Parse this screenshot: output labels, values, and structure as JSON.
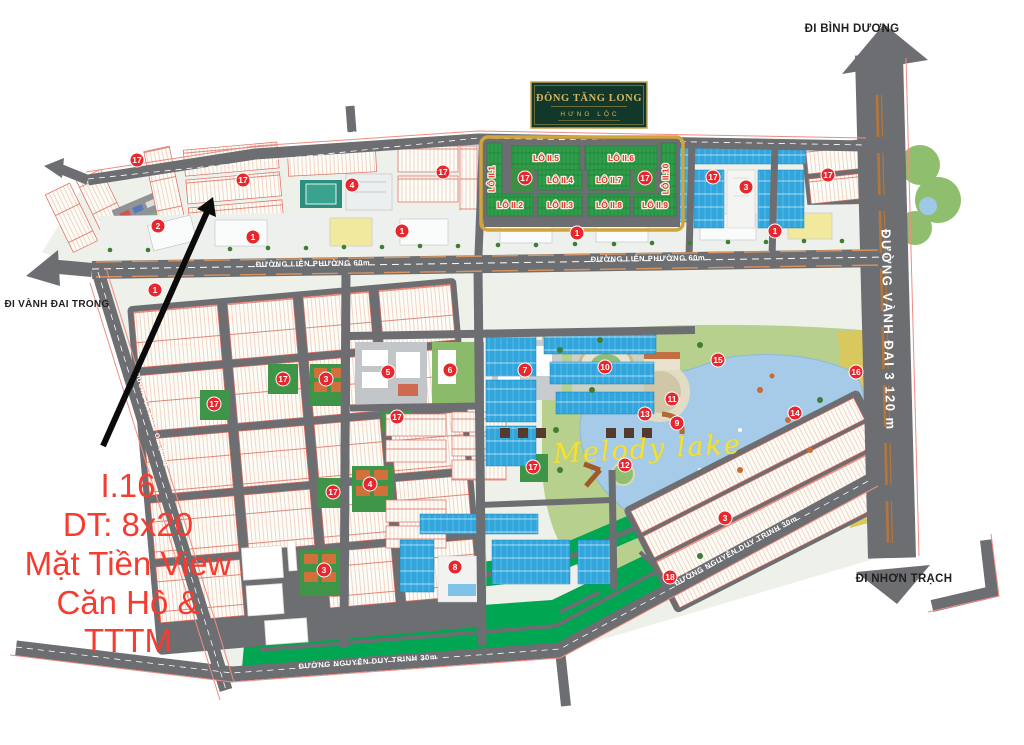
{
  "app": {
    "title": "Sơ đồ phân lô Đông Tăng Long - Hưng Lộc"
  },
  "logo": {
    "name": "ĐÔNG TĂNG LONG",
    "sub": "HƯNG LỘC"
  },
  "directions": {
    "north": "ĐI BÌNH DƯƠNG",
    "south": "ĐI NHƠN TRẠCH",
    "west": "ĐI VÀNH ĐAI TRONG"
  },
  "roads": {
    "vanh_dai_3": "ĐƯỜNG VÀNH ĐAI 3  120 m",
    "lien_phuong": "ĐƯỜNG LIÊN PHƯỜNG  60m",
    "nguyen_duy_trinh": "ĐƯỜNG NGUYỄN DUY TRINH  30m",
    "a1": "ĐƯỜNG A1  20m",
    "la_xuan_oai": "ĐƯỜNG LÃ XUÂN OAI (60m)"
  },
  "lake": {
    "name": "Melody lake"
  },
  "highlight_lots": [
    "LÔ II.1",
    "LÔ II.2",
    "LÔ II.3",
    "LÔ II.4",
    "LÔ II.5",
    "LÔ II.6",
    "LÔ II.7",
    "LÔ II.8",
    "LÔ II.9",
    "LÔ II.10"
  ],
  "annotation": {
    "lines": [
      "I.16",
      "DT: 8x20",
      "Mặt Tiền View",
      "Căn Hộ &",
      "TTTM"
    ]
  },
  "markers": [
    "17",
    "2",
    "17",
    "1",
    "4",
    "17",
    "1",
    "17",
    "17",
    "1",
    "3",
    "17",
    "17",
    "1",
    "1",
    "5",
    "6",
    "7",
    "10",
    "15",
    "16",
    "14",
    "11",
    "13",
    "9",
    "12",
    "17",
    "3",
    "17",
    "17",
    "17",
    "4",
    "17",
    "8",
    "3",
    "18",
    "3"
  ],
  "colors": {
    "marker": "#e8262d",
    "highlight_border": "#d2a43c",
    "lot_green": "#2f9e4a",
    "cyan_lot": "#31a5dc",
    "strip_green": "#00a651",
    "lake_blue": "#a5cbe8",
    "road_gray": "#6d6e71",
    "annotation_red": "#f63b2f"
  }
}
